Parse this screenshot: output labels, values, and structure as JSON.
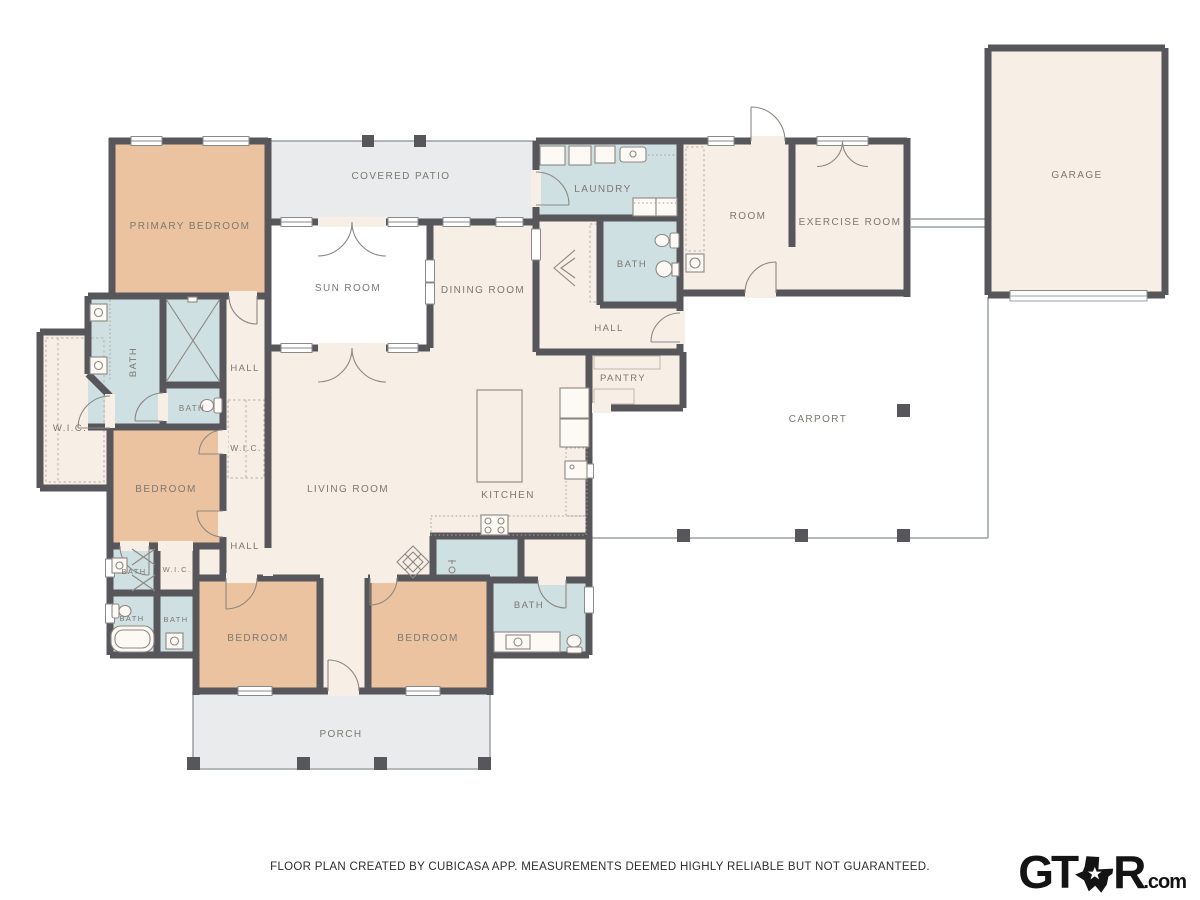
{
  "palette": {
    "wall": "#57565a",
    "floor": "#f7eee6",
    "bedroom": "#ecc3a1",
    "wet": "#cfe0e2",
    "outdoor": "#e9ebed",
    "label": "#7d7870",
    "thin": "#9aa0a4",
    "footer": "#2e2e2e",
    "logo": "#141414"
  },
  "rooms": [
    {
      "label": "PRIMARY BEDROOM"
    },
    {
      "label": "COVERED PATIO"
    },
    {
      "label": "LAUNDRY"
    },
    {
      "label": "ROOM"
    },
    {
      "label": "EXERCISE ROOM"
    },
    {
      "label": "GARAGE"
    },
    {
      "label": "SUN ROOM"
    },
    {
      "label": "DINING ROOM"
    },
    {
      "label": "BATH"
    },
    {
      "label": "HALL"
    },
    {
      "label": "PANTRY"
    },
    {
      "label": "CARPORT"
    },
    {
      "label": "BATH"
    },
    {
      "label": "HALL"
    },
    {
      "label": "BATH"
    },
    {
      "label": "W.I.C."
    },
    {
      "label": "W.I.C."
    },
    {
      "label": "BEDROOM"
    },
    {
      "label": "LIVING ROOM"
    },
    {
      "label": "KITCHEN"
    },
    {
      "label": "HALL"
    },
    {
      "label": "BATH"
    },
    {
      "label": "W.I.C."
    },
    {
      "label": "BATH"
    },
    {
      "label": "BATH"
    },
    {
      "label": "BEDROOM"
    },
    {
      "label": "BEDROOM"
    },
    {
      "label": "BATH"
    },
    {
      "label": "PORCH"
    }
  ],
  "footer": {
    "text": "FLOOR PLAN CREATED BY CUBICASA APP. MEASUREMENTS DEEMED HIGHLY RELIABLE BUT NOT GUARANTEED."
  },
  "brand": {
    "prefix": "GT",
    "suffix_letter": "R",
    "domain": ".com"
  }
}
